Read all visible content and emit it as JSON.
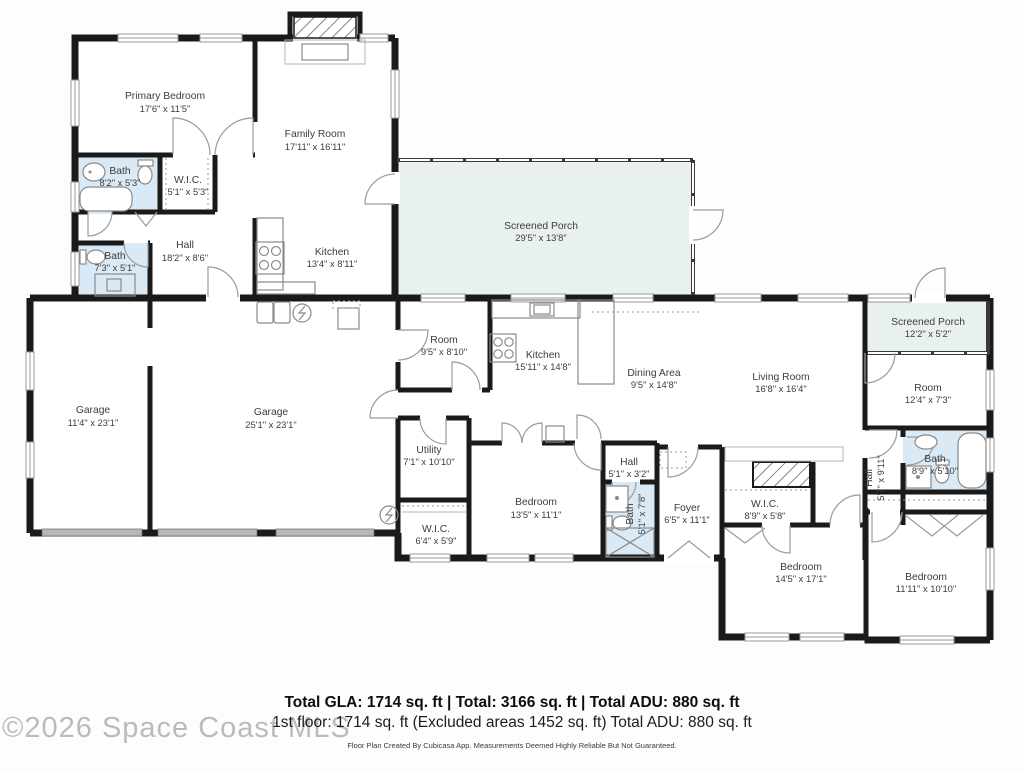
{
  "watermark": "©2026 Space Coast MLS",
  "summary": {
    "line1": "Total GLA: 1714 sq. ft | Total: 3166 sq. ft | Total ADU: 880 sq. ft",
    "line2": "1st floor: 1714 sq. ft (Excluded areas 1452 sq. ft) Total ADU: 880 sq. ft",
    "disclaimer": "Floor Plan Created By Cubicasa App. Measurements Deemed Highly Reliable But Not Guaranteed."
  },
  "colors": {
    "bath_fill": "#d9e9f5",
    "porch_fill": "#e9f1ec",
    "wall": "#1a1a1a",
    "label": "#3c3c3c",
    "garage_door": "#b8b8b8",
    "watermark": "#b0b0b0"
  },
  "icons": [
    "toilet-icon",
    "bathtub-icon",
    "sink-icon",
    "shower-icon",
    "stove-icon",
    "washer-dryer-icon",
    "water-heater-icon",
    "electrical-panel-icon",
    "door-arc",
    "window",
    "garage-door",
    "fireplace-icon",
    "attic-stairs-icon",
    "closet-rod-chevron"
  ],
  "rooms": [
    {
      "name": "Primary Bedroom",
      "dims": "17'6\" x 11'5\""
    },
    {
      "name": "Family Room",
      "dims": "17'11\" x 16'11\""
    },
    {
      "name": "Bath",
      "dims": "8'2\" x 5'3\""
    },
    {
      "name": "W.I.C.",
      "dims": "5'1\" x 5'3\""
    },
    {
      "name": "Hall",
      "dims": "18'2\" x 8'6\""
    },
    {
      "name": "Bath",
      "dims": "7'3\" x 5'1\""
    },
    {
      "name": "Kitchen",
      "dims": "13'4\" x 8'11\""
    },
    {
      "name": "Screened Porch",
      "dims": "29'5\" x 13'8\""
    },
    {
      "name": "Garage",
      "dims": "11'4\" x 23'1\""
    },
    {
      "name": "Garage",
      "dims": "25'1\" x 23'1\""
    },
    {
      "name": "Room",
      "dims": "9'5\" x 8'10\""
    },
    {
      "name": "Kitchen",
      "dims": "15'11\" x 14'8\""
    },
    {
      "name": "Dining Area",
      "dims": "9'5\" x 14'8\""
    },
    {
      "name": "Living Room",
      "dims": "16'8\" x 16'4\""
    },
    {
      "name": "Screened Porch",
      "dims": "12'2\" x 5'2\""
    },
    {
      "name": "Room",
      "dims": "12'4\" x 7'3\""
    },
    {
      "name": "Utility",
      "dims": "7'1\" x 10'10\""
    },
    {
      "name": "Hall",
      "dims": "5'1\" x 3'2\""
    },
    {
      "name": "Bedroom",
      "dims": "13'5\" x 11'1\""
    },
    {
      "name": "Bath",
      "dims": "5'1\" x 7'8\""
    },
    {
      "name": "Foyer",
      "dims": "6'5\" x 11'1\""
    },
    {
      "name": "W.I.C.",
      "dims": "8'9\" x 5'8\""
    },
    {
      "name": "Hall",
      "dims": "5'7\" x 9'11\""
    },
    {
      "name": "Bath",
      "dims": "8'9\" x 5'10\""
    },
    {
      "name": "W.I.C.",
      "dims": "6'4\" x 5'9\""
    },
    {
      "name": "Bedroom",
      "dims": "14'5\" x 17'1\""
    },
    {
      "name": "Bedroom",
      "dims": "11'11\" x 10'10\""
    }
  ]
}
